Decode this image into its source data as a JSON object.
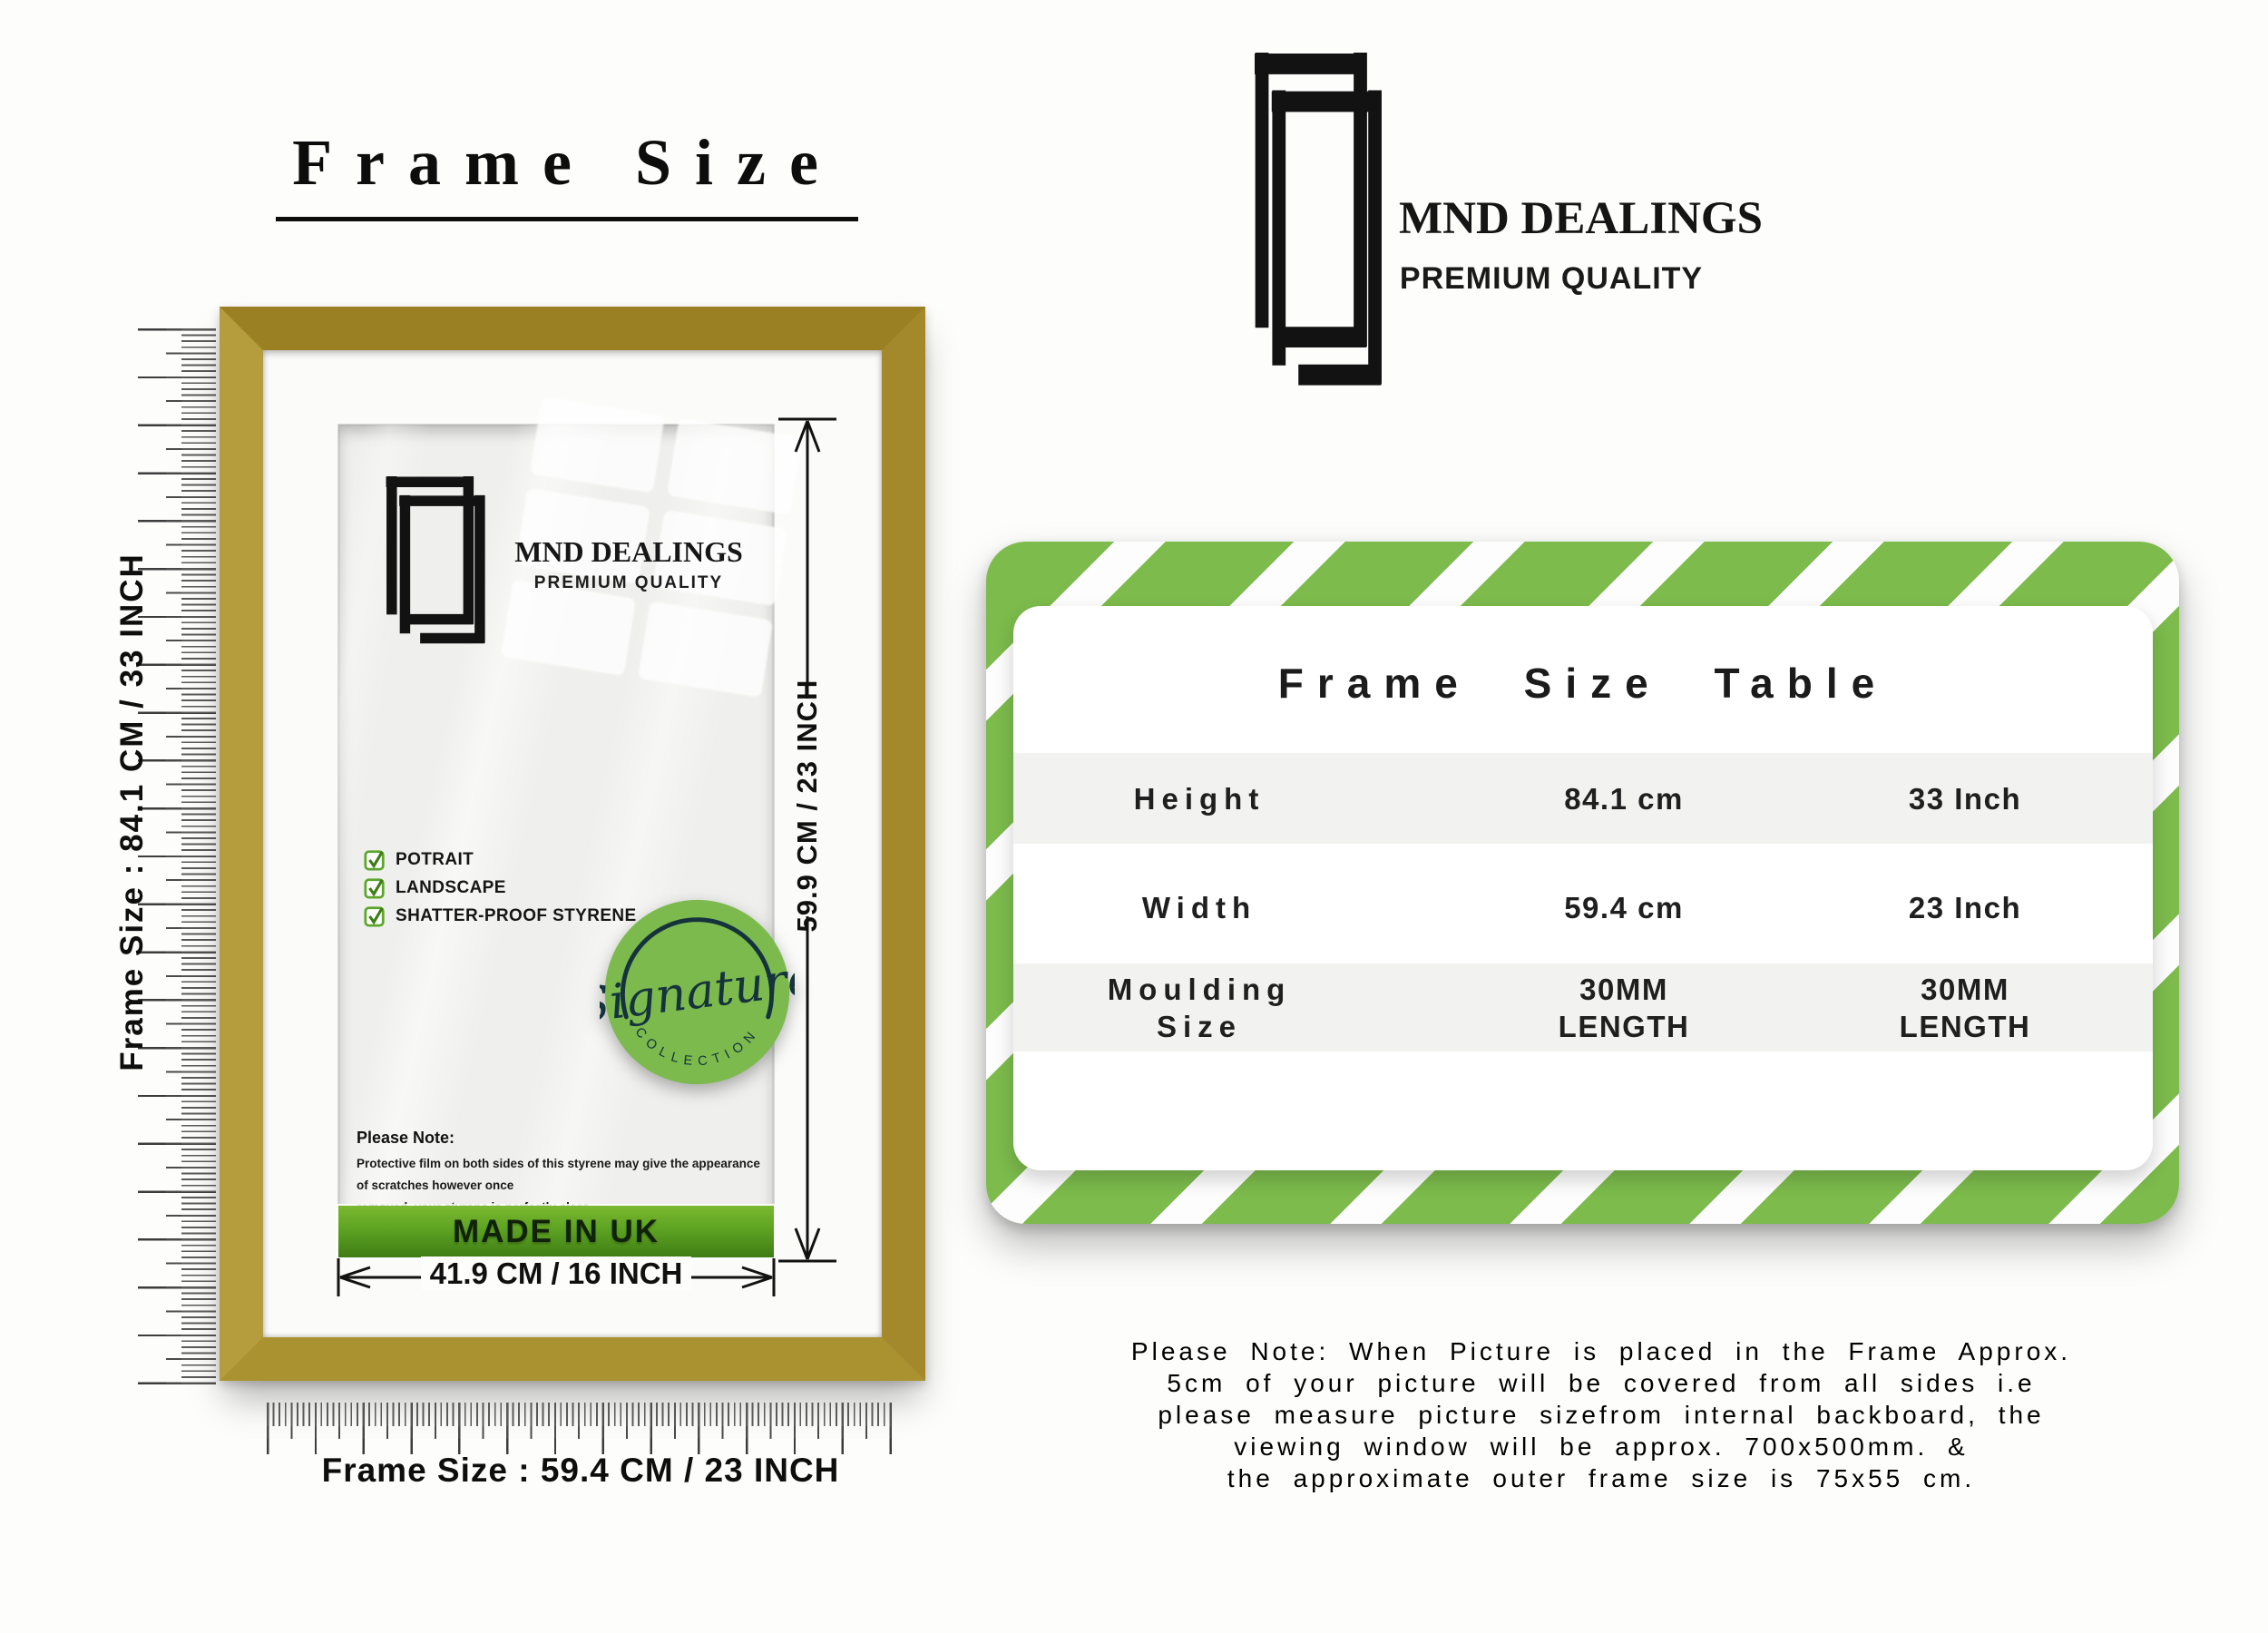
{
  "title": "Frame Size",
  "rulers": {
    "vertical_label": "Frame Size : 84.1 CM / 33 INCH",
    "horizontal_label": "Frame Size : 59.4 CM / 23 INCH"
  },
  "frame": {
    "brand": "MND DEALINGS",
    "brand_tagline": "PREMIUM QUALITY",
    "features": [
      "POTRAIT",
      "LANDSCAPE",
      "SHATTER-PROOF STYRENE"
    ],
    "badge": {
      "script": "Signature",
      "arc_text": "COLLECTION"
    },
    "note_title": "Please Note:",
    "note_body": "Protective film on both sides of this styrene may give the appearance of scratches however once\nremoved, your styrene is perfectly clear,",
    "made_in": "MADE IN UK",
    "dim_height": "59.9 CM / 23 INCH",
    "dim_width": "41.9 CM / 16 INCH"
  },
  "header": {
    "brand": "MND DEALINGS",
    "brand_tagline": "PREMIUM QUALITY"
  },
  "size_table": {
    "title": "Frame Size Table",
    "rows": [
      {
        "label": "Height",
        "cm": "84.1 cm",
        "inch": "33 Inch"
      },
      {
        "label": "Width",
        "cm": "59.4 cm",
        "inch": "23 Inch"
      },
      {
        "label": "Moulding\nSize",
        "cm": "30MM\nLENGTH",
        "inch": "30MM\nLENGTH"
      }
    ]
  },
  "footnote": "Please Note: When Picture is placed in the Frame Approx.\n5cm of your picture will be covered from all sides i.e\nplease measure picture sizefrom internal backboard, the\nviewing window will be approx. 700x500mm. &\nthe approximate outer frame size is 75x55 cm.",
  "colors": {
    "accent_green": "#7cbb4c",
    "badge_green": "#7cba4e",
    "badge_ink": "#14333c",
    "made_in_uk_top": "#7ab930",
    "made_in_uk_bottom": "#3f7d15",
    "frame_gold": "#a48b2c",
    "table_band_gray": "#f2f2f1"
  }
}
